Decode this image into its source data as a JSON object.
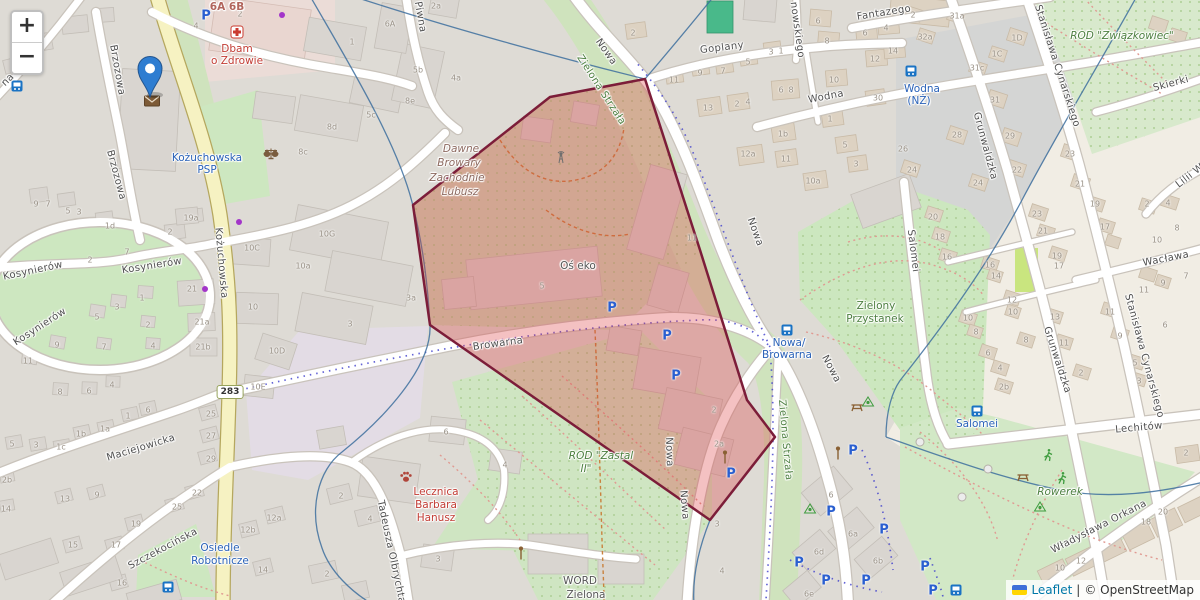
{
  "controls": {
    "zoom_in_label": "+",
    "zoom_out_label": "−"
  },
  "attribution": {
    "leaflet_link": "Leaflet",
    "separator": "|",
    "osm_text": "© OpenStreetMap"
  },
  "overlay": {
    "polygon": {
      "points": [
        [
          550,
          97
        ],
        [
          645,
          79
        ],
        [
          700,
          250
        ],
        [
          747,
          400
        ],
        [
          775,
          437
        ],
        [
          710,
          520
        ],
        [
          430,
          325
        ],
        [
          413,
          205
        ]
      ],
      "fill": "rgba(222,63,66,0.32)",
      "stroke": "#7c1d39",
      "stroke_width": 2.5
    },
    "marker": {
      "x": 150,
      "y": 97,
      "color": "#2e7dd1"
    }
  },
  "road_badge": {
    "text": "283",
    "x": 230,
    "y": 392
  },
  "street_labels": [
    {
      "t": "Brzozowa",
      "x": 117,
      "y": 70,
      "r": 80
    },
    {
      "t": "Brzozowa",
      "x": 116,
      "y": 175,
      "r": 75
    },
    {
      "t": "Kożuchowska",
      "x": 221,
      "y": 263,
      "r": 85
    },
    {
      "t": "Kosynierów",
      "x": 33,
      "y": 271,
      "r": -12
    },
    {
      "t": "Kosynierów",
      "x": 152,
      "y": 266,
      "r": -9
    },
    {
      "t": "Kosynierów",
      "x": 40,
      "y": 327,
      "r": -33
    },
    {
      "t": "Maciejowicka",
      "x": 141,
      "y": 448,
      "r": -17
    },
    {
      "t": "Szczekocińska",
      "x": 163,
      "y": 549,
      "r": -28
    },
    {
      "t": "Tadeusza Olbrychta",
      "x": 391,
      "y": 552,
      "r": 78
    },
    {
      "t": "Piwna",
      "x": 420,
      "y": 17,
      "r": 80
    },
    {
      "t": "na",
      "x": 8,
      "y": 80,
      "r": -45
    },
    {
      "t": "Browarna",
      "x": 498,
      "y": 344,
      "r": -8
    },
    {
      "t": "Nowa",
      "x": 606,
      "y": 52,
      "r": 55
    },
    {
      "t": "Nowa",
      "x": 755,
      "y": 232,
      "r": 70
    },
    {
      "t": "Nowa",
      "x": 831,
      "y": 369,
      "r": 62
    },
    {
      "t": "Nowa",
      "x": 669,
      "y": 452,
      "r": 88
    },
    {
      "t": "Nowa",
      "x": 684,
      "y": 505,
      "r": 85
    },
    {
      "t": "Zielona Strzała",
      "x": 601,
      "y": 90,
      "r": 57,
      "cls": "grn"
    },
    {
      "t": "Zielona Strzała",
      "x": 785,
      "y": 440,
      "r": 85,
      "cls": "grn"
    },
    {
      "t": "Goplany",
      "x": 722,
      "y": 48,
      "r": -7
    },
    {
      "t": "nowskiego",
      "x": 797,
      "y": 30,
      "r": 82
    },
    {
      "t": "Fantazego",
      "x": 884,
      "y": 13,
      "r": -9
    },
    {
      "t": "Wodna",
      "x": 826,
      "y": 97,
      "r": -11
    },
    {
      "t": "Skierki",
      "x": 1171,
      "y": 84,
      "r": -15
    },
    {
      "t": "Grunwaldzka",
      "x": 985,
      "y": 146,
      "r": 75
    },
    {
      "t": "Grunwaldzka",
      "x": 1057,
      "y": 360,
      "r": 72
    },
    {
      "t": "Stanisława Cynarskiego",
      "x": 1057,
      "y": 66,
      "r": 72
    },
    {
      "t": "Stanisława Cynarskiego",
      "x": 1144,
      "y": 356,
      "r": 75
    },
    {
      "t": "Wacława",
      "x": 1166,
      "y": 259,
      "r": -11
    },
    {
      "t": "Lilii W",
      "x": 1190,
      "y": 176,
      "r": -38
    },
    {
      "t": "Salomei",
      "x": 913,
      "y": 251,
      "r": 83
    },
    {
      "t": "Lechitów",
      "x": 1139,
      "y": 428,
      "r": -5
    },
    {
      "t": "Władysława Orkana",
      "x": 1099,
      "y": 527,
      "r": -27
    }
  ],
  "place_labels": [
    {
      "t": "Dbam",
      "x": 237,
      "y": 49,
      "cls": "red"
    },
    {
      "t": "o Zdrowie",
      "x": 237,
      "y": 61,
      "cls": "red"
    },
    {
      "t": "Kożuchowska",
      "x": 207,
      "y": 158,
      "cls": "blu"
    },
    {
      "t": "PSP",
      "x": 207,
      "y": 170,
      "cls": "blu"
    },
    {
      "t": "6A 6B",
      "x": 227,
      "y": 7,
      "cls": "adr"
    },
    {
      "t": "Dawne",
      "x": 461,
      "y": 149,
      "cls": "brn"
    },
    {
      "t": "Browary",
      "x": 459,
      "y": 163,
      "cls": "brn"
    },
    {
      "t": "Zachodnie",
      "x": 457,
      "y": 178,
      "cls": "brn"
    },
    {
      "t": "Lubusz",
      "x": 460,
      "y": 192,
      "cls": "brn"
    },
    {
      "t": "Oś eko",
      "x": 578,
      "y": 266,
      "cls": "gry"
    },
    {
      "t": "ROD \"Zastal",
      "x": 601,
      "y": 456,
      "cls": "grn",
      "i": 1
    },
    {
      "t": "II\"",
      "x": 586,
      "y": 469,
      "cls": "grn",
      "i": 1
    },
    {
      "t": "ROD \"Związkowiec\"",
      "x": 1122,
      "y": 36,
      "cls": "grn",
      "i": 1
    },
    {
      "t": "Zielony",
      "x": 876,
      "y": 306,
      "cls": "grn"
    },
    {
      "t": "Przystanek",
      "x": 875,
      "y": 319,
      "cls": "grn"
    },
    {
      "t": "Rowerek",
      "x": 1060,
      "y": 492,
      "cls": "grn",
      "i": 1
    },
    {
      "t": "Lecznica",
      "x": 436,
      "y": 492,
      "cls": "red"
    },
    {
      "t": "Barbara",
      "x": 436,
      "y": 505,
      "cls": "red"
    },
    {
      "t": "Hanusz",
      "x": 436,
      "y": 518,
      "cls": "red"
    },
    {
      "t": "WORD",
      "x": 580,
      "y": 581,
      "cls": "gry"
    },
    {
      "t": "Zielona",
      "x": 586,
      "y": 595,
      "cls": "gry"
    },
    {
      "t": "Osiedle",
      "x": 220,
      "y": 548,
      "cls": "blu"
    },
    {
      "t": "Robotnicze",
      "x": 220,
      "y": 561,
      "cls": "blu"
    },
    {
      "t": "Nowa/",
      "x": 789,
      "y": 343,
      "cls": "blu"
    },
    {
      "t": "Browarna",
      "x": 787,
      "y": 355,
      "cls": "blu"
    },
    {
      "t": "Wodna",
      "x": 922,
      "y": 89,
      "cls": "blu"
    },
    {
      "t": "(NŻ)",
      "x": 919,
      "y": 101,
      "cls": "blu"
    },
    {
      "t": "Salomei",
      "x": 977,
      "y": 424,
      "cls": "blu"
    }
  ],
  "house_numbers": [
    [
      352,
      42,
      "1"
    ],
    [
      240,
      14,
      "2"
    ],
    [
      196,
      26,
      "4"
    ],
    [
      390,
      24,
      "6A"
    ],
    [
      436,
      6,
      "2a"
    ],
    [
      418,
      70,
      "5b"
    ],
    [
      456,
      78,
      "4a"
    ],
    [
      410,
      101,
      "8e"
    ],
    [
      371,
      115,
      "5c"
    ],
    [
      332,
      127,
      "8d"
    ],
    [
      303,
      152,
      "8c"
    ],
    [
      633,
      33,
      "2"
    ],
    [
      674,
      80,
      "11"
    ],
    [
      700,
      73,
      "9"
    ],
    [
      723,
      71,
      "7"
    ],
    [
      748,
      62,
      "5"
    ],
    [
      771,
      52,
      "3"
    ],
    [
      781,
      51,
      "1"
    ],
    [
      818,
      21,
      "6"
    ],
    [
      827,
      41,
      "8"
    ],
    [
      865,
      33,
      "6"
    ],
    [
      886,
      28,
      "4"
    ],
    [
      875,
      59,
      "12"
    ],
    [
      893,
      51,
      "14"
    ],
    [
      834,
      80,
      "10"
    ],
    [
      781,
      90,
      "6"
    ],
    [
      791,
      90,
      "8"
    ],
    [
      708,
      108,
      "13"
    ],
    [
      737,
      104,
      "2"
    ],
    [
      748,
      102,
      "4"
    ],
    [
      783,
      134,
      "1b"
    ],
    [
      748,
      154,
      "12a"
    ],
    [
      786,
      159,
      "11"
    ],
    [
      830,
      119,
      "1"
    ],
    [
      845,
      145,
      "5"
    ],
    [
      856,
      164,
      "3"
    ],
    [
      813,
      181,
      "10a"
    ],
    [
      878,
      98,
      "30"
    ],
    [
      913,
      15,
      "2"
    ],
    [
      925,
      37,
      "32a"
    ],
    [
      957,
      16,
      "31a"
    ],
    [
      1017,
      38,
      "1D"
    ],
    [
      997,
      54,
      "1C"
    ],
    [
      977,
      68,
      "31c"
    ],
    [
      995,
      100,
      "31"
    ],
    [
      957,
      135,
      "28"
    ],
    [
      1010,
      136,
      "29"
    ],
    [
      1017,
      170,
      "22"
    ],
    [
      978,
      183,
      "24"
    ],
    [
      912,
      170,
      "24"
    ],
    [
      903,
      149,
      "26"
    ],
    [
      1070,
      154,
      "23"
    ],
    [
      1080,
      184,
      "21"
    ],
    [
      933,
      217,
      "20"
    ],
    [
      940,
      237,
      "18"
    ],
    [
      947,
      257,
      "16"
    ],
    [
      1037,
      214,
      "23"
    ],
    [
      1043,
      231,
      "21"
    ],
    [
      1095,
      204,
      "19"
    ],
    [
      1105,
      227,
      "17"
    ],
    [
      1057,
      256,
      "19"
    ],
    [
      1059,
      266,
      "17"
    ],
    [
      990,
      265,
      "16"
    ],
    [
      996,
      276,
      "14"
    ],
    [
      1012,
      300,
      "12"
    ],
    [
      1013,
      312,
      "10"
    ],
    [
      968,
      318,
      "10"
    ],
    [
      976,
      332,
      "8"
    ],
    [
      1055,
      317,
      "13"
    ],
    [
      1110,
      312,
      "11"
    ],
    [
      988,
      353,
      "6"
    ],
    [
      1000,
      368,
      "4"
    ],
    [
      1004,
      387,
      "2b"
    ],
    [
      1026,
      340,
      "8"
    ],
    [
      1064,
      343,
      "11"
    ],
    [
      1120,
      336,
      "9"
    ],
    [
      1147,
      204,
      "2"
    ],
    [
      1168,
      203,
      "4"
    ],
    [
      1157,
      240,
      "10"
    ],
    [
      1177,
      228,
      "8"
    ],
    [
      1144,
      290,
      "11"
    ],
    [
      1163,
      283,
      "9"
    ],
    [
      1186,
      276,
      "7"
    ],
    [
      1165,
      325,
      "6"
    ],
    [
      1135,
      363,
      "5"
    ],
    [
      1139,
      381,
      "3"
    ],
    [
      1081,
      373,
      "2"
    ],
    [
      36,
      204,
      "9"
    ],
    [
      48,
      204,
      "7"
    ],
    [
      68,
      211,
      "5"
    ],
    [
      79,
      212,
      "3"
    ],
    [
      110,
      226,
      "1d"
    ],
    [
      170,
      232,
      "2"
    ],
    [
      191,
      218,
      "19a"
    ],
    [
      127,
      252,
      "7"
    ],
    [
      90,
      260,
      "2"
    ],
    [
      192,
      289,
      "21"
    ],
    [
      202,
      322,
      "21a"
    ],
    [
      203,
      347,
      "21b"
    ],
    [
      252,
      248,
      "10C"
    ],
    [
      253,
      307,
      "10"
    ],
    [
      277,
      351,
      "10D"
    ],
    [
      258,
      387,
      "10E"
    ],
    [
      142,
      298,
      "1"
    ],
    [
      117,
      307,
      "3"
    ],
    [
      97,
      317,
      "5"
    ],
    [
      148,
      325,
      "2"
    ],
    [
      153,
      346,
      "4"
    ],
    [
      104,
      347,
      "7"
    ],
    [
      57,
      345,
      "9"
    ],
    [
      28,
      361,
      "11"
    ],
    [
      60,
      392,
      "8"
    ],
    [
      89,
      391,
      "6"
    ],
    [
      112,
      385,
      "4"
    ],
    [
      211,
      414,
      "25"
    ],
    [
      211,
      436,
      "27"
    ],
    [
      211,
      459,
      "29"
    ],
    [
      197,
      493,
      "22"
    ],
    [
      177,
      507,
      "25"
    ],
    [
      136,
      524,
      "19"
    ],
    [
      73,
      545,
      "15"
    ],
    [
      116,
      545,
      "17"
    ],
    [
      122,
      583,
      "16"
    ],
    [
      65,
      499,
      "13"
    ],
    [
      97,
      495,
      "9"
    ],
    [
      12,
      444,
      "5"
    ],
    [
      36,
      445,
      "3"
    ],
    [
      61,
      447,
      "1c"
    ],
    [
      81,
      434,
      "1b"
    ],
    [
      105,
      429,
      "1a"
    ],
    [
      128,
      416,
      "1"
    ],
    [
      148,
      410,
      "6"
    ],
    [
      7,
      480,
      "2b"
    ],
    [
      6,
      509,
      "14"
    ],
    [
      274,
      518,
      "12a"
    ],
    [
      248,
      530,
      "12b"
    ],
    [
      263,
      570,
      "14"
    ],
    [
      327,
      234,
      "10G"
    ],
    [
      303,
      266,
      "10a"
    ],
    [
      411,
      298,
      "3a"
    ],
    [
      350,
      324,
      "3"
    ],
    [
      542,
      286,
      "5"
    ],
    [
      692,
      238,
      "11"
    ],
    [
      446,
      432,
      "6"
    ],
    [
      505,
      465,
      "4"
    ],
    [
      341,
      496,
      "2"
    ],
    [
      370,
      519,
      "4"
    ],
    [
      438,
      559,
      "3"
    ],
    [
      327,
      574,
      "2"
    ],
    [
      714,
      410,
      "2"
    ],
    [
      719,
      444,
      "2a"
    ],
    [
      717,
      524,
      "3"
    ],
    [
      722,
      571,
      "4"
    ],
    [
      831,
      495,
      "6"
    ],
    [
      853,
      534,
      "6a"
    ],
    [
      819,
      552,
      "6d"
    ],
    [
      878,
      561,
      "6b"
    ],
    [
      809,
      594,
      "6e"
    ],
    [
      1146,
      522,
      "18"
    ],
    [
      1163,
      512,
      "20"
    ],
    [
      1060,
      568,
      "10"
    ],
    [
      1081,
      561,
      "12"
    ],
    [
      1186,
      453,
      "2"
    ]
  ],
  "parking_positions": [
    [
      206,
      16
    ],
    [
      612,
      308
    ],
    [
      667,
      336
    ],
    [
      676,
      376
    ],
    [
      731,
      474
    ],
    [
      853,
      451
    ],
    [
      831,
      512
    ],
    [
      884,
      530
    ],
    [
      799,
      563
    ],
    [
      826,
      581
    ],
    [
      866,
      581
    ],
    [
      925,
      567
    ],
    [
      933,
      591
    ]
  ],
  "pois": [
    {
      "x": 237,
      "y": 32,
      "icon": "pharmacy-cross"
    },
    {
      "x": 271,
      "y": 154,
      "icon": "scales"
    },
    {
      "x": 152,
      "y": 101,
      "icon": "post-envelope"
    },
    {
      "x": 406,
      "y": 477,
      "icon": "paw"
    },
    {
      "x": 561,
      "y": 157,
      "icon": "mast"
    },
    {
      "x": 787,
      "y": 330,
      "icon": "bus"
    },
    {
      "x": 911,
      "y": 71,
      "icon": "bus"
    },
    {
      "x": 977,
      "y": 411,
      "icon": "bus"
    },
    {
      "x": 956,
      "y": 590,
      "icon": "bus"
    },
    {
      "x": 17,
      "y": 86,
      "icon": "bus"
    },
    {
      "x": 168,
      "y": 587,
      "icon": "bus"
    },
    {
      "x": 868,
      "y": 401,
      "icon": "playground"
    },
    {
      "x": 810,
      "y": 508,
      "icon": "playground"
    },
    {
      "x": 1040,
      "y": 506,
      "icon": "playground"
    },
    {
      "x": 857,
      "y": 407,
      "icon": "picnic"
    },
    {
      "x": 1023,
      "y": 477,
      "icon": "picnic"
    },
    {
      "x": 1048,
      "y": 455,
      "icon": "runner"
    },
    {
      "x": 1062,
      "y": 478,
      "icon": "runner"
    },
    {
      "x": 725,
      "y": 457,
      "icon": "lamp"
    },
    {
      "x": 838,
      "y": 453,
      "icon": "lamp"
    },
    {
      "x": 521,
      "y": 553,
      "icon": "lamp"
    },
    {
      "x": 282,
      "y": 15,
      "icon": "dot"
    },
    {
      "x": 239,
      "y": 222,
      "icon": "dot"
    },
    {
      "x": 205,
      "y": 289,
      "icon": "dot"
    },
    {
      "x": 920,
      "y": 442,
      "icon": "node-circle"
    },
    {
      "x": 988,
      "y": 469,
      "icon": "node-circle"
    },
    {
      "x": 962,
      "y": 497,
      "icon": "node-circle"
    }
  ]
}
